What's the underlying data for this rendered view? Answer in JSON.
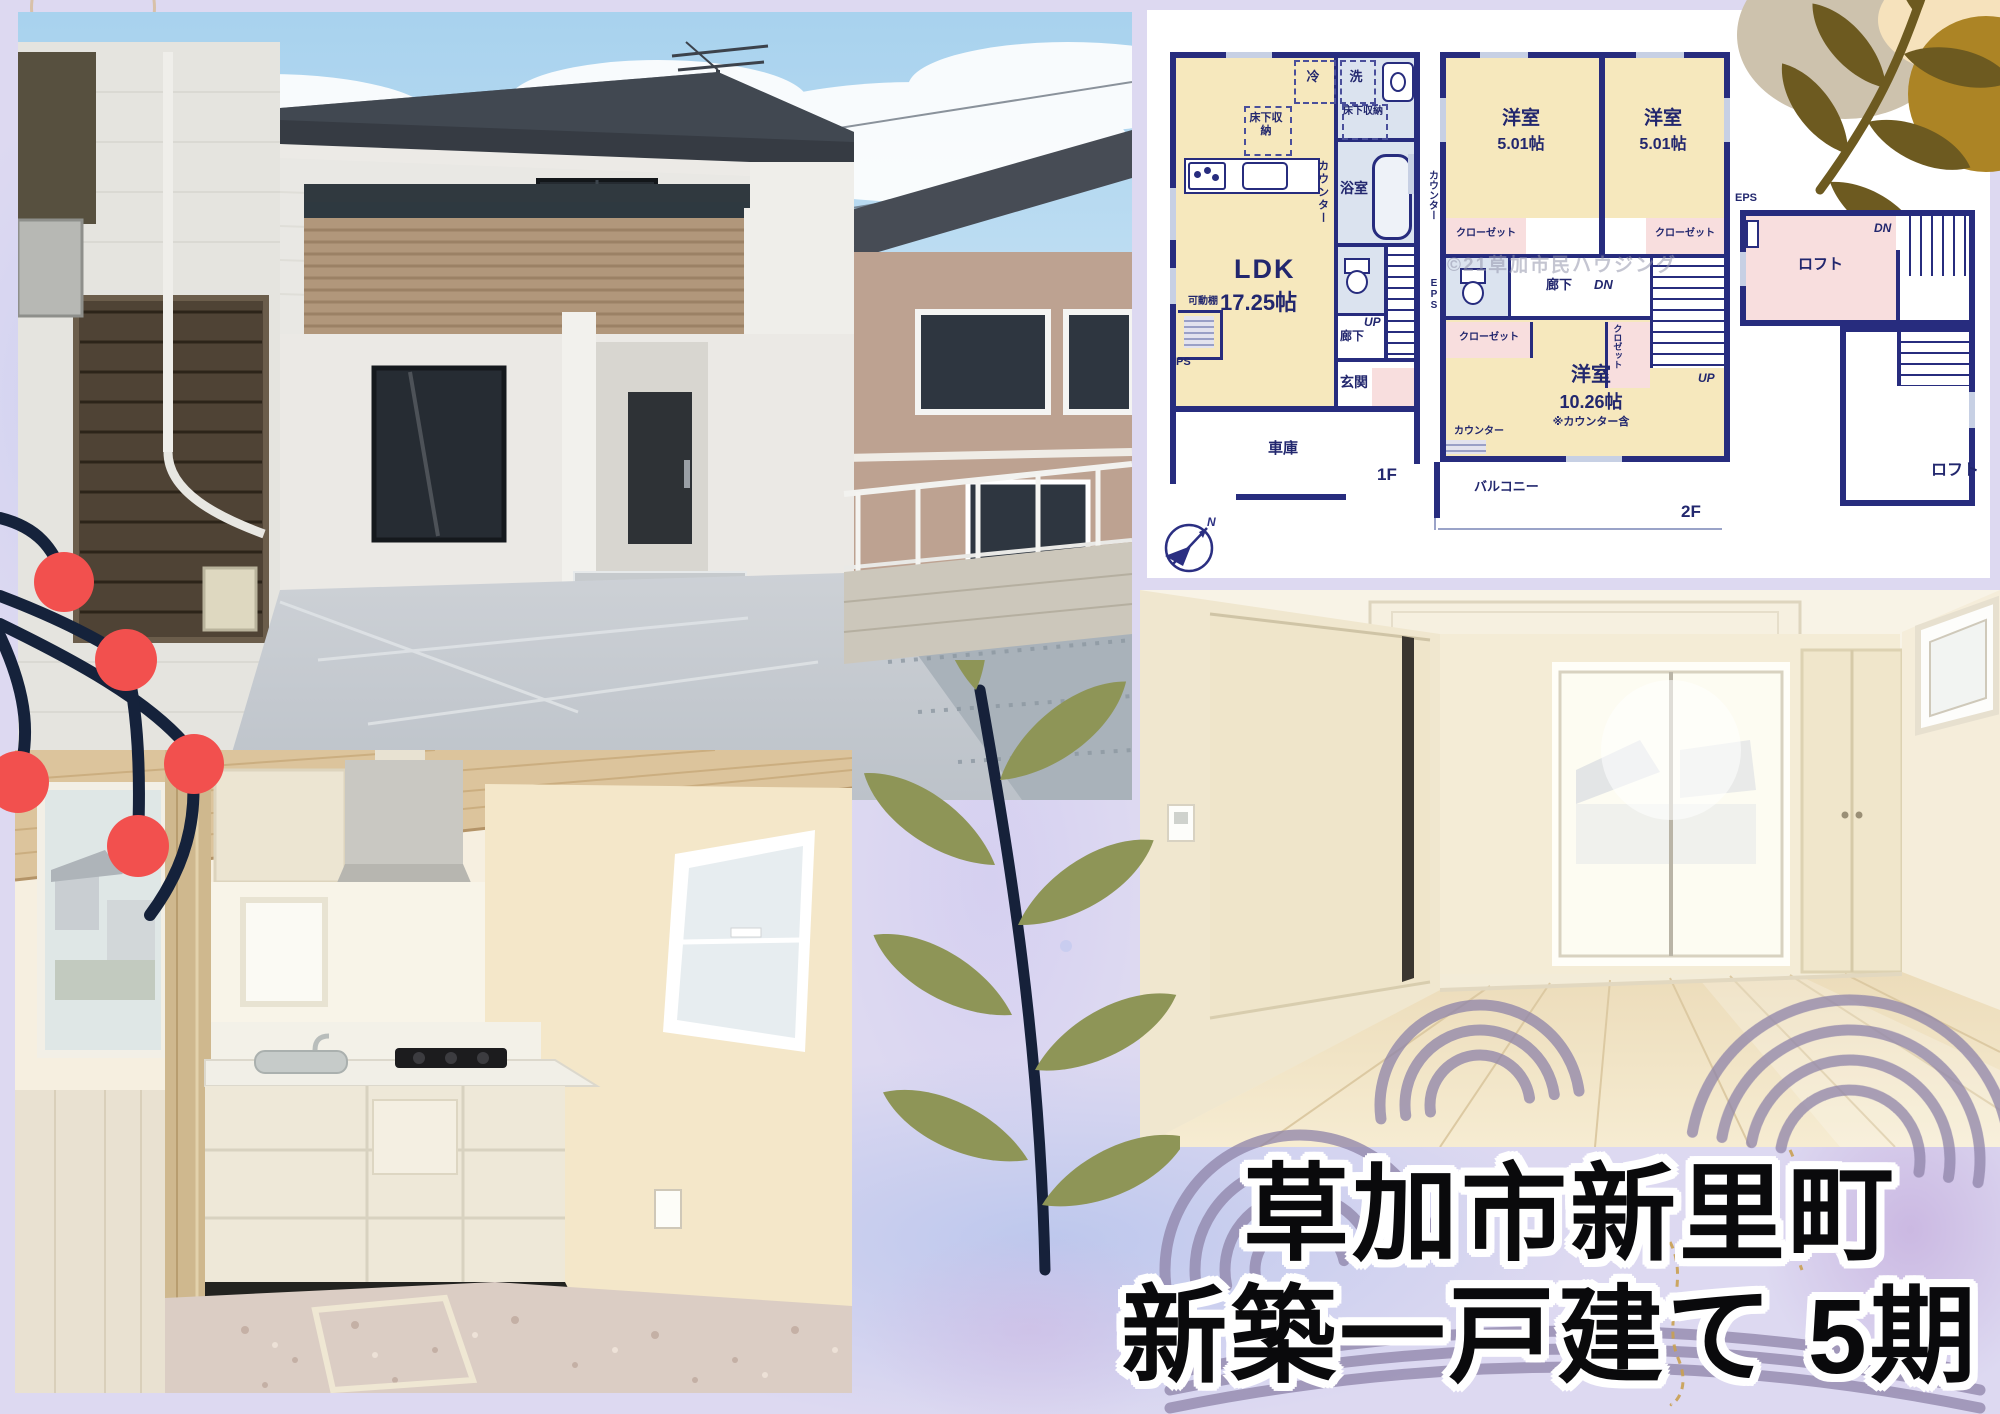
{
  "poster": {
    "title_line1": "草加市新里町",
    "title_line2": "新築一戸建て 5期"
  },
  "floor_plan": {
    "floor1": {
      "name": "1F",
      "ldk_label": "LDK",
      "ldk_size": "17.25帖",
      "fridge": "冷",
      "washer": "洗",
      "washroom": "洗面所",
      "underfloor_storage": "床下収納",
      "bathroom": "浴室",
      "counter": "カウンター",
      "movable_shelf": "可動棚",
      "pipe_space": "PS",
      "up": "UP",
      "hallway": "廊下",
      "entrance": "玄関",
      "garage": "車庫"
    },
    "floor2": {
      "name": "2F",
      "western_room": "洋室",
      "room_a_size": "5.01帖",
      "room_b_size": "5.01帖",
      "closet": "クローゼット",
      "closet_small": "クロゼット",
      "hallway": "廊下",
      "down": "DN",
      "up": "UP",
      "main_room_size": "10.26帖",
      "main_room_note": "※カウンター含",
      "counter": "カウンター",
      "eps": "EPS",
      "balcony": "バルコニー",
      "watermark": "©21草加市民ハウジング"
    },
    "loft": {
      "name": "ロフト",
      "room": "ロフト",
      "eps": "EPS",
      "down": "DN"
    },
    "compass": {
      "north": "N"
    }
  },
  "palette": {
    "background_lavender": "#ddd9f1",
    "plan_navy": "#272c7e",
    "room_cream": "#f6e8bd",
    "room_blue": "#dbe3ef",
    "room_pink": "#f8dede",
    "berry_red": "#f2504e",
    "branch_navy": "#15223b",
    "leaf_olive": "#8e9557",
    "gold_leaf": "#6d5a20",
    "arc_mauve": "#8e83a9",
    "title_black": "#0a0a0c"
  }
}
